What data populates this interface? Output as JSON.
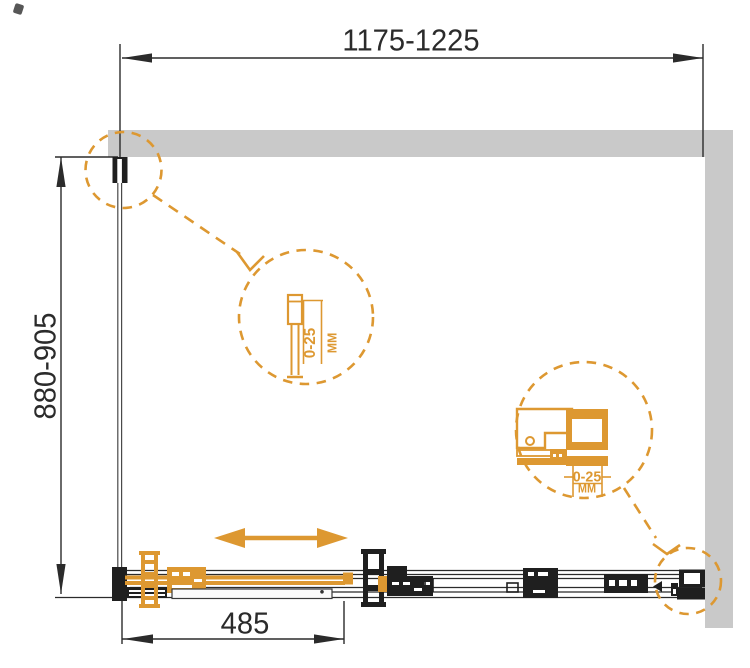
{
  "drawing": {
    "width_dimension": "1175-1225",
    "height_dimension": "880-905",
    "door_opening_dimension": "485",
    "detail_wall_profile": {
      "adjustment": "0-25",
      "unit": "мм"
    },
    "detail_wall_bracket": {
      "adjustment": "0-25",
      "unit": "мм"
    },
    "colors": {
      "accent_orange": "#DD9831",
      "wall_gray": "#C9C9C9",
      "line_black": "#2B2B2B"
    }
  }
}
